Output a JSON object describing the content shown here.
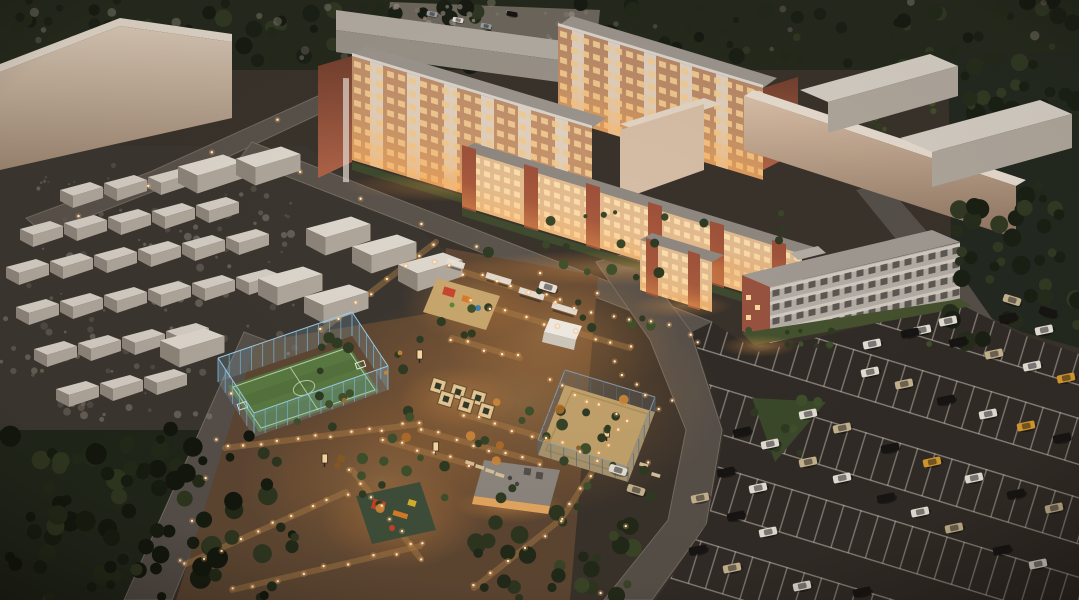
{
  "scene": {
    "label": "Aerial dusk 3D rendering of a residential complex: brick apartment blocks with lit windows, glowing landscaped courtyard with playgrounds, fenced soccer field, sand sports court, garage rows, warehouses and a large car parking lot"
  },
  "palette": {
    "ground": "#3a332c",
    "road": "#5b544c",
    "parking_asphalt": "#312c27",
    "courtyard_warm": "#5e4733",
    "glow_orange": "#ffb966",
    "window_lit": "#ffd9a2",
    "facade_brick": "#9c5a42",
    "facade_cream": "#e3bd92",
    "balcony_white": "#e6dfd5",
    "roof_grey": "#97918a",
    "warehouse_beige": "#d6c3af",
    "garage_roof": "#d9d3c9",
    "tree_dark": "#1c2117",
    "field_green": "#5a7a42",
    "fence_blue": "#8fc3e4",
    "sand": "#c4a36c",
    "line_white": "#cfc8bd"
  },
  "vegetation": {
    "zones": [
      {
        "x": 0,
        "y": 0,
        "w": 1079,
        "h": 66,
        "n": 120,
        "seed": 7,
        "r0": 3,
        "r1": 9,
        "colors": [
          "#161b12",
          "#232a1a",
          "#2f3823",
          "#1b2016"
        ],
        "op": 1,
        "layer": "back"
      },
      {
        "x": 0,
        "y": 0,
        "w": 1079,
        "h": 58,
        "n": 26,
        "seed": 11,
        "r0": 2,
        "r1": 5,
        "colors": [
          "#8a8278",
          "#6f685f"
        ],
        "op": 0.45,
        "layer": "back"
      },
      {
        "x": 952,
        "y": 52,
        "w": 127,
        "h": 150,
        "n": 34,
        "seed": 5,
        "r0": 4,
        "r1": 10,
        "colors": [
          "#1a2015",
          "#262d1c",
          "#323a24"
        ],
        "op": 1,
        "layer": "back"
      },
      {
        "x": 0,
        "y": 158,
        "w": 300,
        "h": 266,
        "n": 150,
        "seed": 31,
        "r0": 1,
        "r1": 4,
        "colors": [
          "#797267",
          "#8d867a",
          "#645e54"
        ],
        "op": 0.5,
        "layer": "back"
      },
      {
        "x": 392,
        "y": 2,
        "w": 205,
        "h": 42,
        "n": 26,
        "seed": 33,
        "r0": 1.5,
        "r1": 4,
        "colors": [
          "#938b80",
          "#7c756b"
        ],
        "op": 0.8,
        "layer": "back"
      },
      {
        "x": 826,
        "y": 100,
        "w": 140,
        "h": 30,
        "n": 16,
        "seed": 37,
        "r0": 2,
        "r1": 5,
        "colors": [
          "#333c24",
          "#414f2c"
        ],
        "op": 1,
        "layer": "back"
      },
      {
        "x": 948,
        "y": 195,
        "w": 131,
        "h": 148,
        "n": 40,
        "seed": 9,
        "r0": 4,
        "r1": 10,
        "colors": [
          "#1a2015",
          "#262d1c",
          "#323a24"
        ],
        "op": 1,
        "layer": "front"
      },
      {
        "x": 0,
        "y": 425,
        "w": 295,
        "h": 175,
        "n": 90,
        "seed": 3,
        "r0": 4,
        "r1": 11,
        "colors": [
          "#161c10",
          "#222a18",
          "#2e3620",
          "#12170d"
        ],
        "op": 1,
        "layer": "front"
      },
      {
        "x": 468,
        "y": 512,
        "w": 165,
        "h": 88,
        "n": 30,
        "seed": 13,
        "r0": 4,
        "r1": 9,
        "colors": [
          "#222a18",
          "#2e3620",
          "#3a4527"
        ],
        "op": 1,
        "layer": "front"
      },
      {
        "x": 296,
        "y": 330,
        "w": 150,
        "h": 118,
        "n": 16,
        "seed": 17,
        "r0": 3,
        "r1": 6,
        "colors": [
          "#2f3b22",
          "#40512c"
        ],
        "op": 1,
        "layer": "front"
      },
      {
        "x": 430,
        "y": 252,
        "w": 240,
        "h": 84,
        "n": 18,
        "seed": 19,
        "r0": 3,
        "r1": 6,
        "colors": [
          "#2f3b22",
          "#40512c"
        ],
        "op": 1,
        "layer": "front"
      },
      {
        "x": 478,
        "y": 400,
        "w": 180,
        "h": 112,
        "n": 20,
        "seed": 21,
        "r0": 3,
        "r1": 6,
        "colors": [
          "#2f3b22",
          "#40512c",
          "#374428"
        ],
        "op": 1,
        "layer": "front"
      },
      {
        "x": 352,
        "y": 432,
        "w": 130,
        "h": 80,
        "n": 12,
        "seed": 23,
        "r0": 3,
        "r1": 6,
        "colors": [
          "#2f3b22",
          "#40512c"
        ],
        "op": 1,
        "layer": "front"
      },
      {
        "x": 330,
        "y": 350,
        "w": 310,
        "h": 160,
        "n": 15,
        "seed": 25,
        "r0": 2,
        "r1": 5,
        "colors": [
          "#8a5a26",
          "#b06f2a",
          "#d08a38"
        ],
        "op": 0.9,
        "layer": "front"
      },
      {
        "x": 748,
        "y": 328,
        "w": 215,
        "h": 22,
        "n": 12,
        "seed": 27,
        "r0": 2,
        "r1": 4,
        "colors": [
          "#2f3b22",
          "#40512c"
        ],
        "op": 1,
        "layer": "front"
      },
      {
        "x": 462,
        "y": 212,
        "w": 340,
        "h": 36,
        "n": 14,
        "seed": 29,
        "r0": 2,
        "r1": 5,
        "colors": [
          "#2f3b22",
          "#3a4728"
        ],
        "op": 1,
        "layer": "front"
      },
      {
        "x": 752,
        "y": 400,
        "w": 70,
        "h": 58,
        "n": 10,
        "seed": 39,
        "r0": 3,
        "r1": 6,
        "colors": [
          "#2f3b22",
          "#40512c"
        ],
        "op": 1,
        "layer": "front"
      }
    ]
  },
  "lighting": {
    "rows": [
      [
        225,
        448,
        420,
        424,
        12,
        1
      ],
      [
        352,
        470,
        420,
        558,
        8,
        1
      ],
      [
        186,
        564,
        346,
        492,
        10,
        1
      ],
      [
        232,
        590,
        420,
        546,
        9,
        1
      ],
      [
        420,
        430,
        540,
        462,
        8,
        1
      ],
      [
        462,
        414,
        600,
        454,
        9,
        1
      ],
      [
        432,
        262,
        560,
        302,
        9,
        1
      ],
      [
        472,
        302,
        630,
        348,
        10,
        1
      ],
      [
        556,
        302,
        688,
        332,
        8,
        0
      ],
      [
        436,
        242,
        322,
        330,
        8,
        1
      ],
      [
        612,
        362,
        658,
        408,
        5,
        0
      ],
      [
        618,
        432,
        562,
        518,
        7,
        1
      ],
      [
        560,
        520,
        474,
        588,
        6,
        1
      ],
      [
        548,
        382,
        628,
        420,
        7,
        0
      ],
      [
        382,
        440,
        468,
        464,
        6,
        1
      ],
      [
        300,
        174,
        598,
        295,
        6,
        0
      ],
      [
        280,
        122,
        80,
        216,
        4,
        0
      ],
      [
        700,
        340,
        600,
        590,
        5,
        0
      ],
      [
        230,
        396,
        180,
        560,
        5,
        0
      ],
      [
        452,
        338,
        520,
        358,
        5,
        1
      ]
    ]
  },
  "vehicles": {
    "colors": {
      "w": "#e8e2d8",
      "k": "#171412",
      "be": "#c9b690",
      "y": "#d89b2e",
      "gr": "#9aa0a4",
      "dk": "#3a3f45"
    },
    "fleet": [
      [
        742,
        432,
        -12,
        "k"
      ],
      [
        770,
        444,
        -12,
        "w"
      ],
      [
        808,
        462,
        -12,
        "be"
      ],
      [
        842,
        478,
        -12,
        "w"
      ],
      [
        886,
        498,
        -12,
        "k"
      ],
      [
        920,
        512,
        -12,
        "w"
      ],
      [
        954,
        528,
        -12,
        "be"
      ],
      [
        1002,
        550,
        -12,
        "k"
      ],
      [
        1038,
        564,
        -12,
        "w"
      ],
      [
        726,
        472,
        -12,
        "k"
      ],
      [
        758,
        488,
        -12,
        "w"
      ],
      [
        700,
        498,
        -12,
        "be"
      ],
      [
        736,
        516,
        -12,
        "k"
      ],
      [
        768,
        532,
        -12,
        "w"
      ],
      [
        698,
        550,
        -12,
        "k"
      ],
      [
        732,
        568,
        -12,
        "be"
      ],
      [
        802,
        586,
        -12,
        "w"
      ],
      [
        862,
        592,
        -12,
        "k"
      ],
      [
        808,
        414,
        -12,
        "w"
      ],
      [
        842,
        428,
        -12,
        "be"
      ],
      [
        890,
        448,
        -12,
        "k"
      ],
      [
        932,
        462,
        -12,
        "y"
      ],
      [
        974,
        478,
        -12,
        "w"
      ],
      [
        1016,
        494,
        -12,
        "k"
      ],
      [
        1054,
        508,
        -12,
        "be"
      ],
      [
        870,
        372,
        -12,
        "w"
      ],
      [
        904,
        384,
        -12,
        "be"
      ],
      [
        946,
        400,
        -12,
        "k"
      ],
      [
        988,
        414,
        -12,
        "w"
      ],
      [
        1026,
        426,
        -12,
        "y"
      ],
      [
        1062,
        438,
        -12,
        "k"
      ],
      [
        922,
        330,
        -12,
        "w"
      ],
      [
        958,
        342,
        -12,
        "k"
      ],
      [
        994,
        354,
        -12,
        "be"
      ],
      [
        1032,
        366,
        -12,
        "w"
      ],
      [
        1066,
        378,
        -12,
        "y"
      ],
      [
        1008,
        318,
        -12,
        "k"
      ],
      [
        1044,
        330,
        -12,
        "w"
      ],
      [
        872,
        344,
        -12,
        "w"
      ],
      [
        910,
        333,
        -12,
        "k"
      ],
      [
        948,
        321,
        -12,
        "w"
      ],
      [
        1012,
        300,
        17,
        "be"
      ],
      [
        1048,
        312,
        17,
        "k"
      ],
      [
        618,
        470,
        17,
        "w"
      ],
      [
        636,
        490,
        17,
        "be"
      ],
      [
        548,
        287,
        17,
        "w"
      ],
      [
        432,
        14,
        10,
        "gr",
        0.6
      ],
      [
        458,
        20,
        10,
        "w",
        0.6
      ],
      [
        486,
        26,
        10,
        "gr",
        0.6
      ],
      [
        512,
        14,
        10,
        "k",
        0.6
      ]
    ]
  },
  "garages": {
    "units": [
      [
        60,
        183,
        "g"
      ],
      [
        104,
        176,
        "g"
      ],
      [
        148,
        170,
        "g"
      ],
      [
        192,
        164,
        "g"
      ],
      [
        20,
        222,
        "g"
      ],
      [
        64,
        216,
        "g"
      ],
      [
        108,
        210,
        "g"
      ],
      [
        152,
        204,
        "g"
      ],
      [
        196,
        198,
        "g"
      ],
      [
        6,
        260,
        "g"
      ],
      [
        50,
        254,
        "g"
      ],
      [
        94,
        248,
        "g"
      ],
      [
        138,
        242,
        "g"
      ],
      [
        182,
        236,
        "g"
      ],
      [
        226,
        230,
        "g"
      ],
      [
        16,
        300,
        "g"
      ],
      [
        60,
        294,
        "g"
      ],
      [
        104,
        288,
        "g"
      ],
      [
        148,
        282,
        "g"
      ],
      [
        192,
        276,
        "g"
      ],
      [
        236,
        270,
        "g"
      ],
      [
        34,
        342,
        "g"
      ],
      [
        78,
        336,
        "g"
      ],
      [
        122,
        330,
        "g"
      ],
      [
        166,
        324,
        "g"
      ],
      [
        56,
        382,
        "g"
      ],
      [
        100,
        376,
        "g"
      ],
      [
        144,
        370,
        "g"
      ],
      [
        306,
        218,
        "s"
      ],
      [
        352,
        236,
        "s"
      ],
      [
        398,
        254,
        "s"
      ],
      [
        258,
        268,
        "s"
      ],
      [
        304,
        286,
        "s"
      ],
      [
        178,
        156,
        "s"
      ],
      [
        236,
        148,
        "s"
      ],
      [
        160,
        330,
        "s"
      ]
    ]
  },
  "fences": {
    "field": {
      "h": 24,
      "step": 12,
      "fill": "rgba(150,205,235,0.18)",
      "rail": "#9ecfeb",
      "post": "#7fb6d8",
      "pts": [
        [
          218,
          382
        ],
        [
          352,
          336
        ],
        [
          388,
          390
        ],
        [
          254,
          437
        ]
      ]
    },
    "court": {
      "h": 15,
      "step": 14,
      "fill": "rgba(90,110,125,0.25)",
      "rail": "#8a9aa8",
      "post": "#5a6a76",
      "pts": [
        [
          565,
          385
        ],
        [
          655,
          412
        ],
        [
          628,
          482
        ],
        [
          538,
          455
        ]
      ]
    }
  },
  "furniture": {
    "boards": [
      [
        322,
        454
      ],
      [
        417,
        350
      ],
      [
        433,
        442
      ],
      [
        604,
        428
      ]
    ],
    "benches": [
      [
        466,
        460
      ],
      [
        476,
        464
      ],
      [
        486,
        468
      ],
      [
        496,
        472
      ],
      [
        640,
        462
      ],
      [
        652,
        472
      ]
    ],
    "planters": [
      [
        438,
        386
      ],
      [
        458,
        392
      ],
      [
        478,
        398
      ],
      [
        446,
        399
      ],
      [
        466,
        405
      ],
      [
        486,
        411
      ]
    ],
    "pergolas": [
      [
        487,
        272,
        26
      ],
      [
        520,
        287,
        26
      ],
      [
        553,
        302,
        26
      ],
      [
        448,
        258,
        18
      ]
    ]
  }
}
